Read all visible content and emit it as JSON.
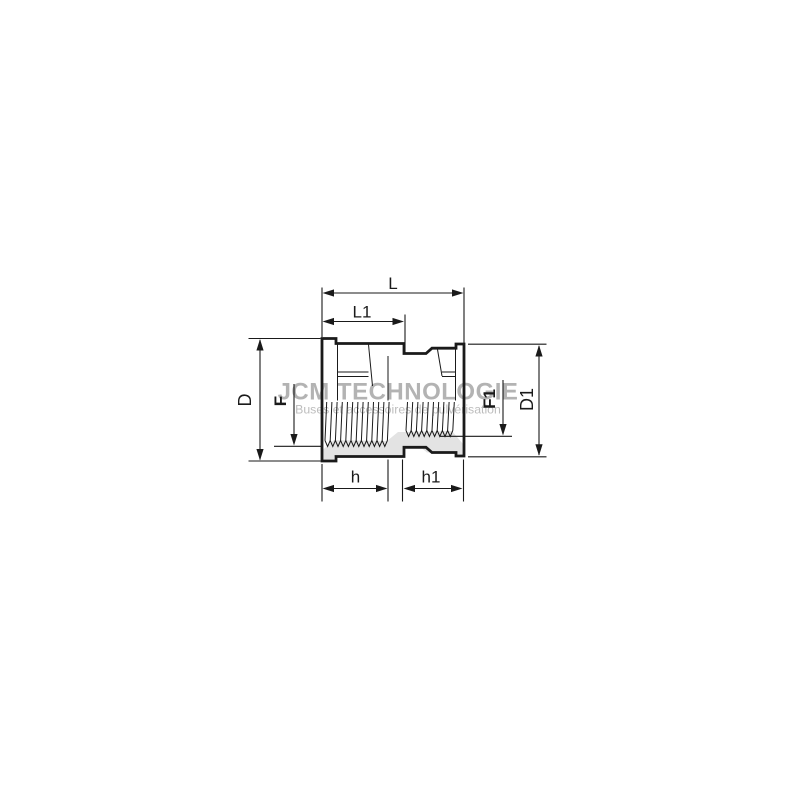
{
  "watermark": {
    "title": "JCM TECHNOLOGIE",
    "subtitle": "Buses et accessoires de pulvérisation"
  },
  "dimensions": {
    "overall_length": "L",
    "left_port_length": "L1",
    "left_outer_diameter": "D",
    "left_thread": "F",
    "right_thread": "F1",
    "right_outer_diameter": "D1",
    "left_thread_depth": "h",
    "right_thread_depth": "h1"
  },
  "colors": {
    "line": "#1a1a1a",
    "section_fill": "#e3e3e3",
    "watermark_title": "#b3b3b3",
    "watermark_subtitle": "#bdbdbd",
    "background": "#ffffff"
  }
}
